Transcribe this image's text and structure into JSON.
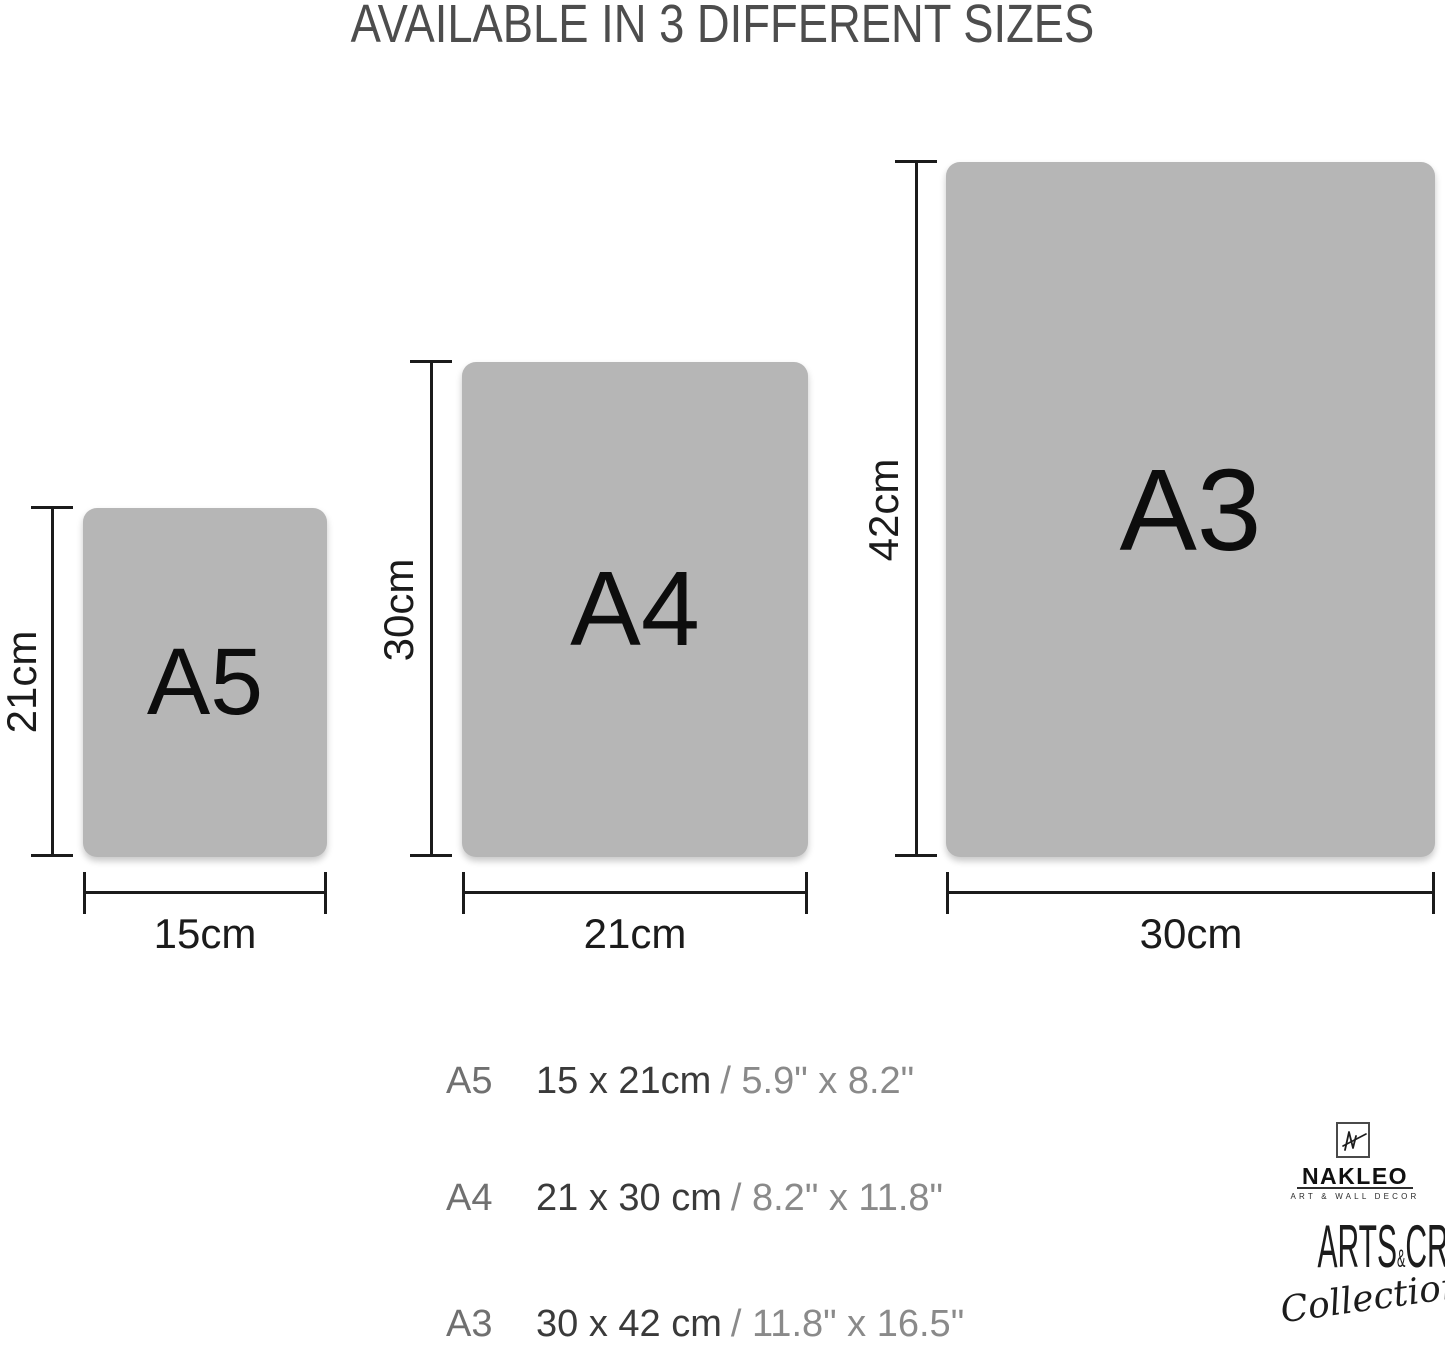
{
  "title": "AVAILABLE IN 3 DIFFERENT SIZES",
  "sizes": [
    {
      "code": "A5",
      "height_label": "21cm",
      "width_label": "15cm"
    },
    {
      "code": "A4",
      "height_label": "30cm",
      "width_label": "21cm"
    },
    {
      "code": "A3",
      "height_label": "42cm",
      "width_label": "30cm"
    }
  ],
  "size_list": [
    {
      "code": "A5",
      "metric": "15 x 21cm",
      "imperial": "/ 5.9\" x 8.2\""
    },
    {
      "code": "A4",
      "metric": "21 x 30 cm",
      "imperial": "/ 8.2\" x 11.8\""
    },
    {
      "code": "A3",
      "metric": "30 x 42 cm",
      "imperial": "/ 11.8\" x 16.5\""
    }
  ],
  "brand": {
    "monogram": "NL",
    "name": "NAKLEO",
    "tagline": "ART & WALL DECOR",
    "collection_arts": "ARTS",
    "collection_amp": "&",
    "collection_crafts": "CRAFTS",
    "collection_script": "Collection"
  },
  "colors": {
    "paper_fill": "#b6b6b6",
    "paper_text": "#0d0d0d",
    "dimension_lines": "#1b1b1b",
    "title_text": "#4d4d4d",
    "list_code": "#707070",
    "list_metric": "#3a3a3a",
    "list_imperial": "#8a8a8a",
    "brand_ink": "#1c1c1c"
  }
}
